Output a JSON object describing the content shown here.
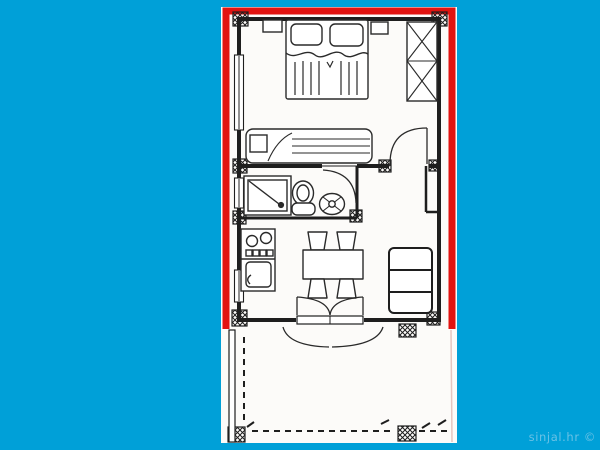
{
  "background_color": "#00A0D8",
  "watermark": {
    "text": "sinjal.hr ©",
    "color": "#7CC7E8"
  },
  "plan": {
    "paper_color": "#FCFBF9",
    "outline_color": "#E21310",
    "line_color": "#1E1E1E",
    "terrace_edge_color": "#E5C6C0",
    "rooms": [
      "bedroom",
      "bathroom",
      "hallway",
      "kitchen",
      "dining-area",
      "living-area",
      "terrace"
    ],
    "furniture_icons": [
      "double-bed-icon",
      "pillow-icon",
      "nightstand-icon",
      "wardrobe-icon",
      "single-bed-icon",
      "shower-icon",
      "toilet-icon",
      "washbasin-icon",
      "cooktop-icon",
      "kitchen-sink-icon",
      "dining-table-icon",
      "chair-icon",
      "sofa-icon",
      "door-swing-icon",
      "double-door-icon",
      "window-icon",
      "column-icon",
      "terrace-dashed-boundary"
    ]
  }
}
